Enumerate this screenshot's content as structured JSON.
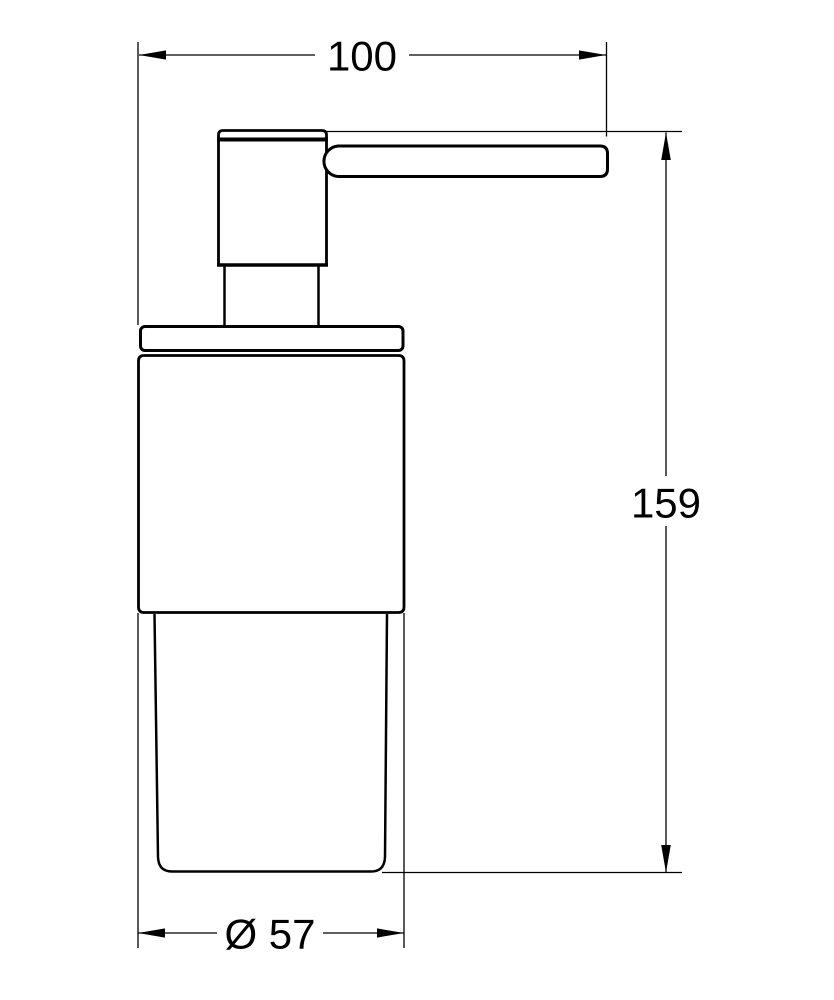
{
  "drawing": {
    "type": "technical-dimension-drawing",
    "subject": "soap-dispenser-with-pump",
    "labels": {
      "width": "100",
      "height": "159",
      "diameter": "Ø 57"
    },
    "colors": {
      "line": "#000000",
      "background": "#ffffff"
    }
  }
}
